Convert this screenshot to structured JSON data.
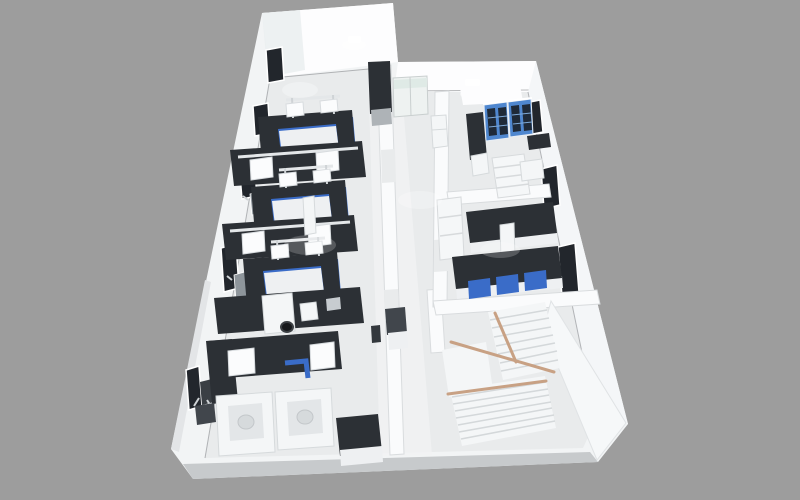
{
  "meta": {
    "description": "3D isometric architectural rendering of a laboratory floor plan viewed from above, with white walls, lab island benches with dark countertops and blue cabinet fronts, blue glass-front storage cabinets, biosafety cabinets, and a switchback staircase with wooden handrails",
    "width": 800,
    "height": 500
  },
  "colors": {
    "bg": "#9d9d9d",
    "wall": "#f2f4f5",
    "wallBright": "#fdfdfe",
    "wallShade": "#e3e5e7",
    "outerShade": "#c7cacc",
    "floor": "#e9ebec",
    "floorLight": "#f1f3f4",
    "dark": "#2c3035",
    "dark2": "#41464c",
    "blue": "#3a6cc8",
    "cabBlue": "#4f87cf",
    "pane": "#1f2a38",
    "windowDark": "#22262c",
    "frame": "#ffffff",
    "rail": "#c8a184",
    "tread": "#f4f6f7",
    "treadEdge": "#d4d8da",
    "grayPanel": "#8e959b",
    "glass": "#dfeae6"
  },
  "scene": {
    "areas": [
      "open-lab-left",
      "corridor",
      "storage-room-top-right",
      "instrument-room-right",
      "stair-hall"
    ],
    "objects": [
      "island-bench-with-blue-cabinets",
      "overhead-reagent-shelves",
      "biosafety-cabinets",
      "blue-glass-storage-cabinets",
      "lab-refrigerator",
      "open-shelf-unit",
      "switchback-staircase",
      "wood-handrails",
      "wall-windows",
      "wall-mounted-monitors",
      "double-glass-door",
      "tall-dark-cabinet",
      "utility-cart",
      "analyzer-equipment"
    ],
    "window_count_left_wall": 5,
    "window_count_right_wall": 3
  }
}
